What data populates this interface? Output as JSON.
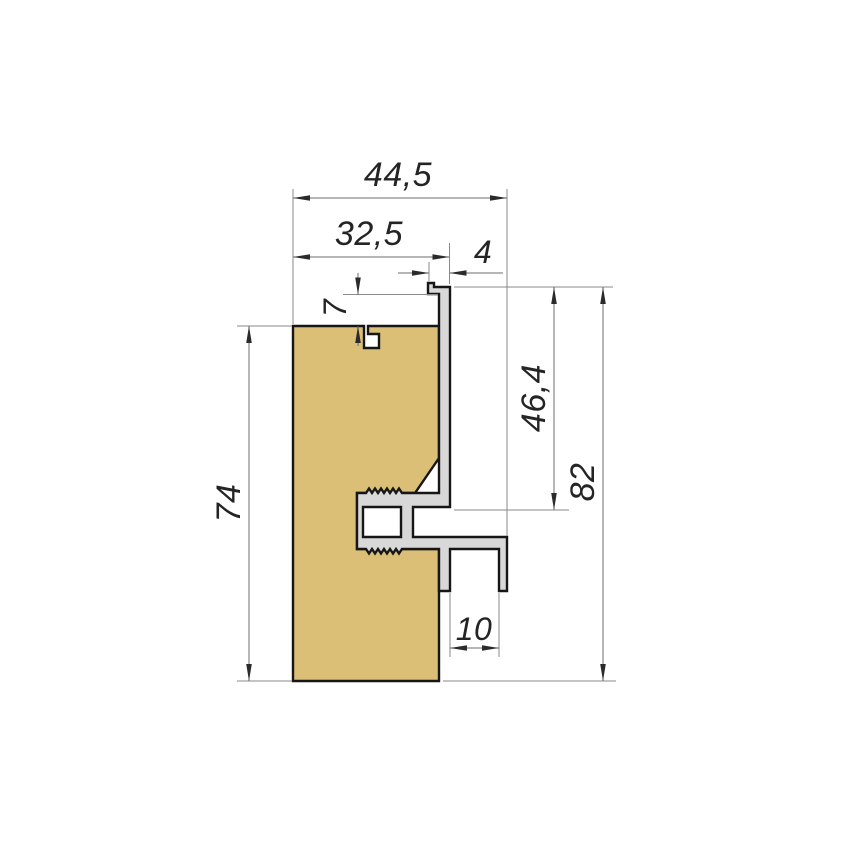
{
  "drawing": {
    "type": "technical-cross-section",
    "subject": "aluminum edge profile mounted on wooden panel",
    "dimensions": {
      "overall_width": "44,5",
      "upper_width": "32,5",
      "lip_width": "4",
      "panel_gap": "7",
      "wood_height": "74",
      "web_height": "46,4",
      "overall_height": "82",
      "channel_gap": "10"
    },
    "colors": {
      "background": "#ffffff",
      "wood_fill": "#dcbf76",
      "aluminum_fill": "#d8d8d8",
      "outline": "#161616",
      "dimension_line": "#6e6e6e",
      "dimension_text": "#242424"
    }
  }
}
